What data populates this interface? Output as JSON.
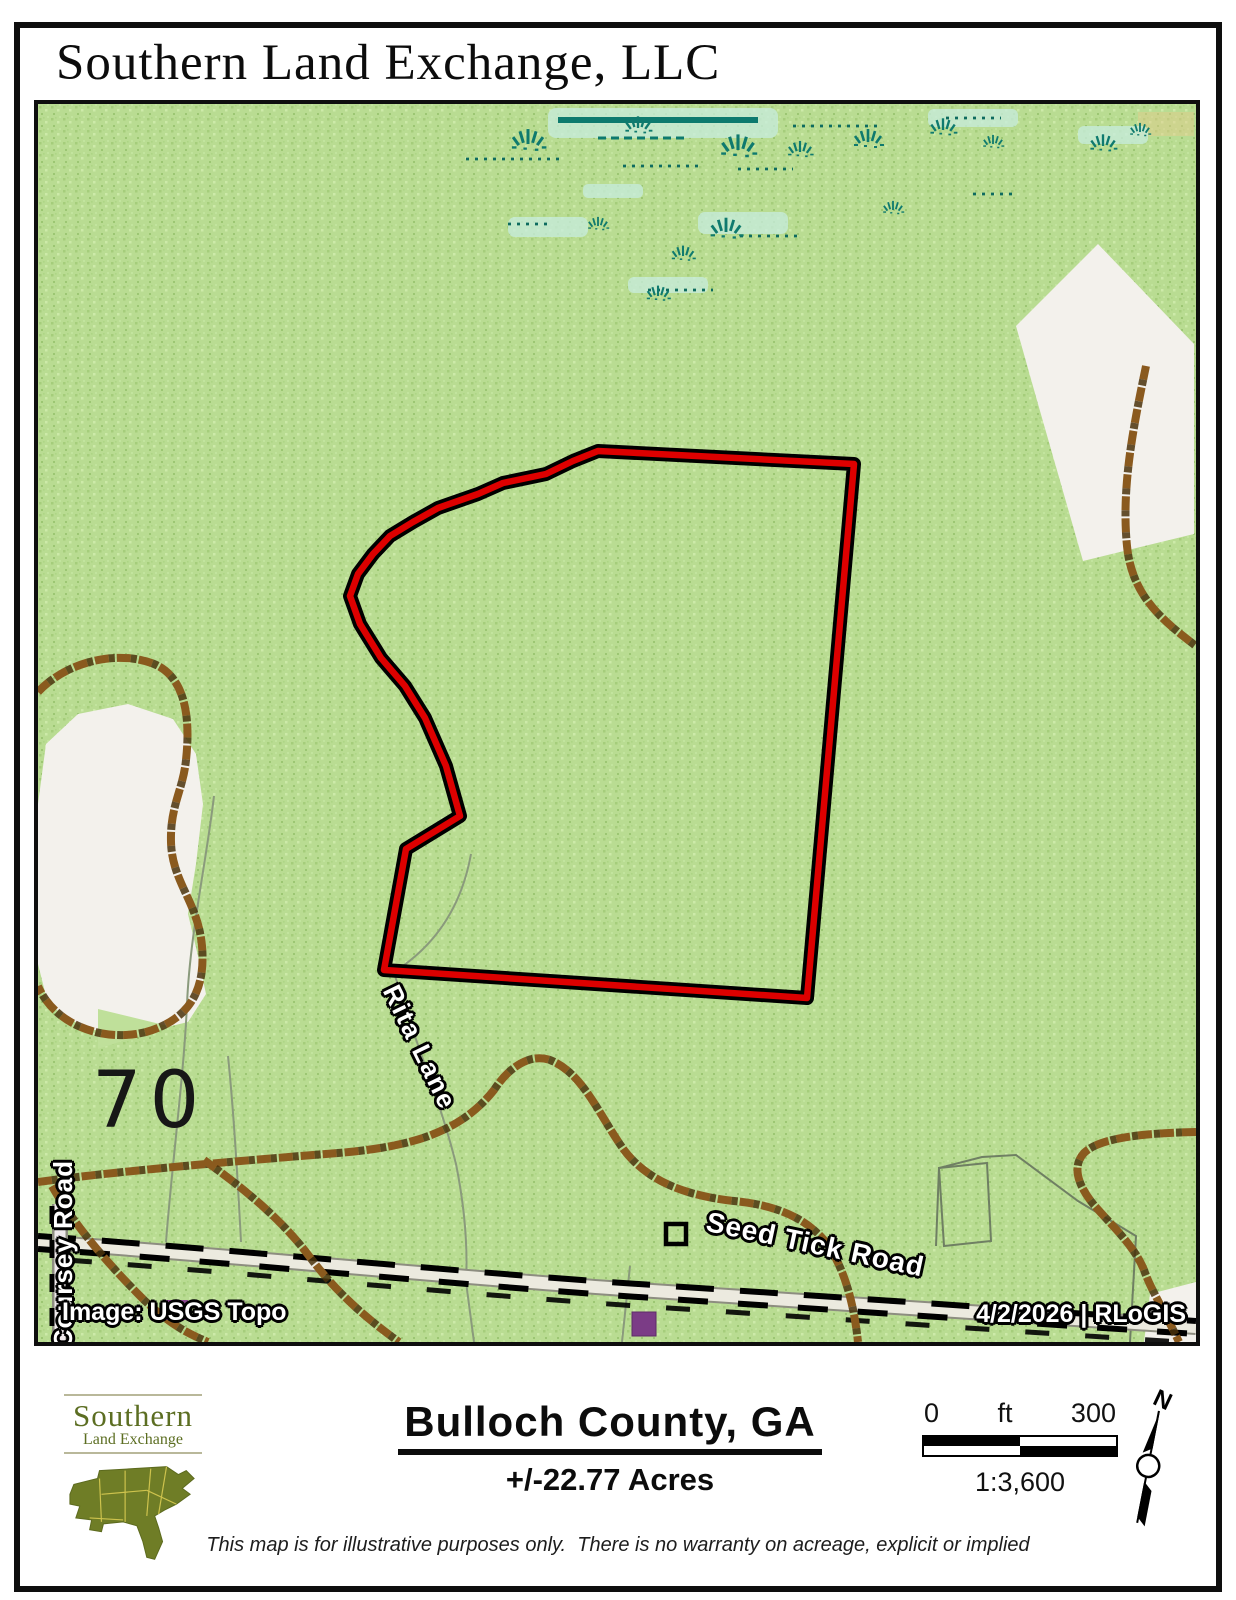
{
  "page": {
    "title": "Southern Land Exchange, LLC"
  },
  "map": {
    "labels": {
      "road_rita": "Rita Lane",
      "road_seed_tick": "Seed Tick Road",
      "road_coursey": "Coursey Road",
      "lot_number": "70",
      "credit": "Image: USGS Topo",
      "stamp": "4/2/2026  |  RLoGIS"
    },
    "colors": {
      "land_green": "#b9dc92",
      "boundary_red": "#dd0000",
      "boundary_casing": "#000000",
      "road_brown": "#8a5a1e",
      "marsh_teal": "#0f7a6e",
      "marsh_cyan": "#c7ecdb",
      "building_purple": "#7b3c86",
      "clearing_white": "#f3f1ec"
    }
  },
  "footer": {
    "logo_line1": "Southern",
    "logo_line2": "Land Exchange",
    "county": "Bulloch County, GA",
    "acreage": "+/-22.77 Acres",
    "scale_zero": "0",
    "scale_unit": "ft",
    "scale_max": "300",
    "scale_ratio": "1:3,600",
    "north_label": "N",
    "disclaimer": "This map is for illustrative purposes only.  There is no warranty on acreage, explicit or implied"
  }
}
